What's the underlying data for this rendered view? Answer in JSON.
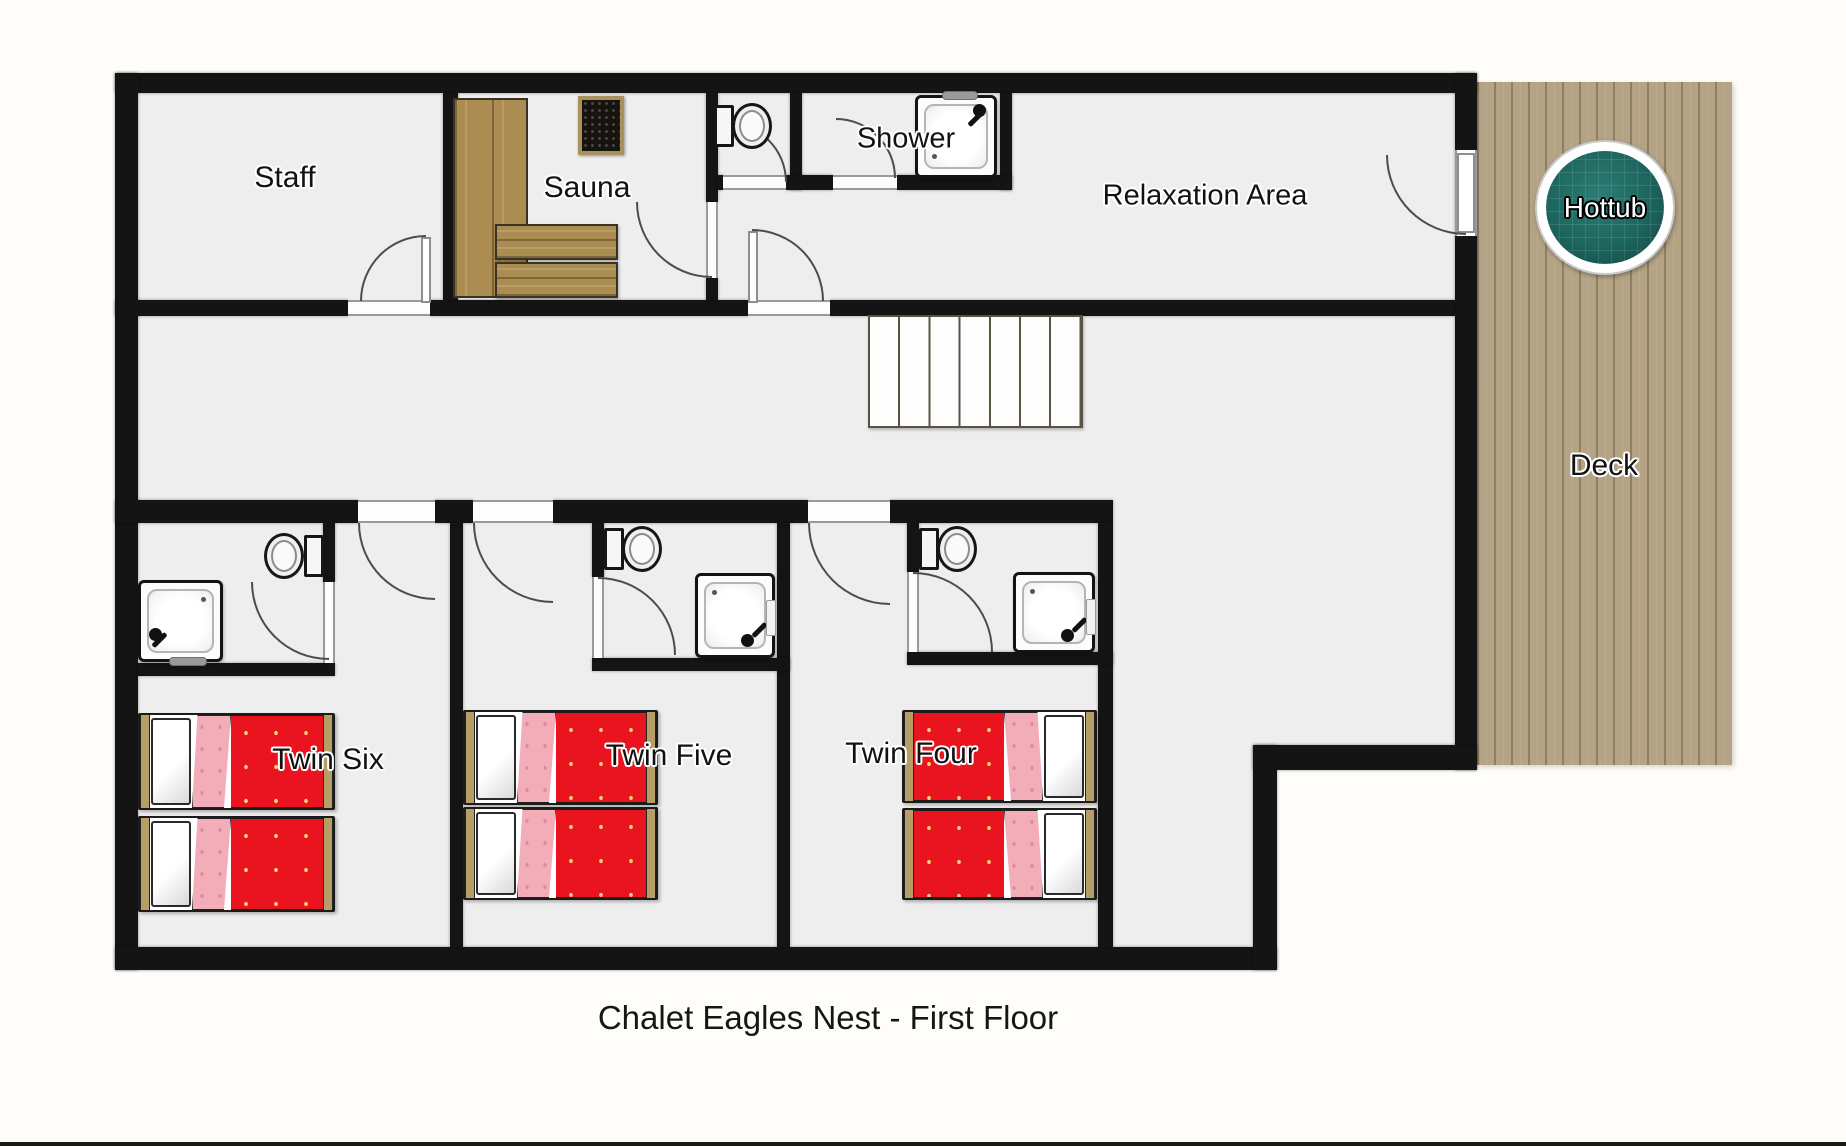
{
  "title": "Chalet Eagles Nest - First Floor",
  "rooms": {
    "staff": {
      "label": "Staff"
    },
    "sauna": {
      "label": "Sauna"
    },
    "shower": {
      "label": "Shower"
    },
    "relaxation": {
      "label": "Relaxation Area"
    },
    "twin_six": {
      "label": "Twin Six"
    },
    "twin_five": {
      "label": "Twin Five"
    },
    "twin_four": {
      "label": "Twin Four"
    }
  },
  "outdoor": {
    "deck": {
      "label": "Deck"
    },
    "hottub": {
      "label": "Hottub"
    }
  },
  "colors": {
    "wall": "#141414",
    "floor": "#eeeeef",
    "bed_red": "#e9141f",
    "bed_pink": "#f3adb8",
    "wood": "#ab8d52",
    "deck": "#b4a384",
    "hottub_teal": "#1d655e",
    "frame_tan": "#b59f66"
  }
}
